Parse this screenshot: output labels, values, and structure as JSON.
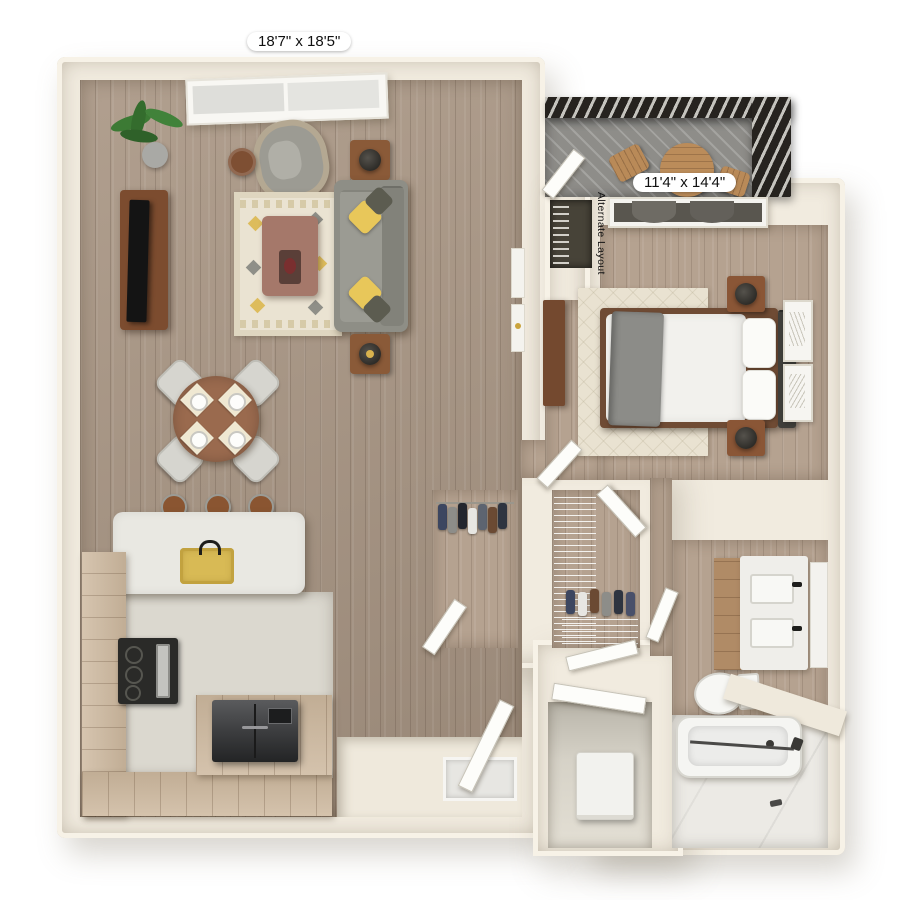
{
  "labels": {
    "living_dimensions": "18'7\" x 18'5\"",
    "bedroom_dimensions": "11'4\" x 14'4\"",
    "alternate_layout": "Alternate Layout"
  },
  "palette": {
    "background": "#ffffff",
    "wall": "#f1ebdf",
    "wood_floor": "#aa9785",
    "wood_floor_light": "#b5a290",
    "cabinet_wood": "#cdb89e",
    "balcony_rail": "#26231f",
    "balcony_floor": "#8e8d89",
    "rug": "#eae3d2",
    "sofa_gray": "#8e8e86",
    "pillow_yellow": "#e8c75a",
    "furniture_brown": "#8a5a38",
    "appliance_dark": "#2a2a28",
    "fixture_white": "#f5f5f2",
    "marble": "#eceae5",
    "label_text": "#101010"
  },
  "rooms": [
    "living-dining-room",
    "kitchen",
    "entry",
    "balcony",
    "bedroom",
    "reach-in-closet",
    "walk-in-closet",
    "linen-closet",
    "bathroom",
    "laundry-closet"
  ],
  "furniture": [
    "potted-plant",
    "tv-console",
    "tv",
    "armchair",
    "side-table",
    "sofa",
    "end-tables",
    "lamps",
    "area-rug",
    "coffee-table",
    "dining-table",
    "dining-chairs",
    "place-settings",
    "kitchen-island",
    "gold-sink",
    "bar-stools",
    "range",
    "refrigerator",
    "front-door",
    "door-mat",
    "hanging-clothes",
    "wire-shelving",
    "bed",
    "mattress",
    "throw-blanket",
    "pillows",
    "headboard",
    "nightstands",
    "dresser",
    "wall-art",
    "bedroom-window",
    "double-vanity",
    "vanity-sinks",
    "toilet",
    "bathtub",
    "washer-dryer",
    "balcony-table",
    "balcony-chairs"
  ]
}
